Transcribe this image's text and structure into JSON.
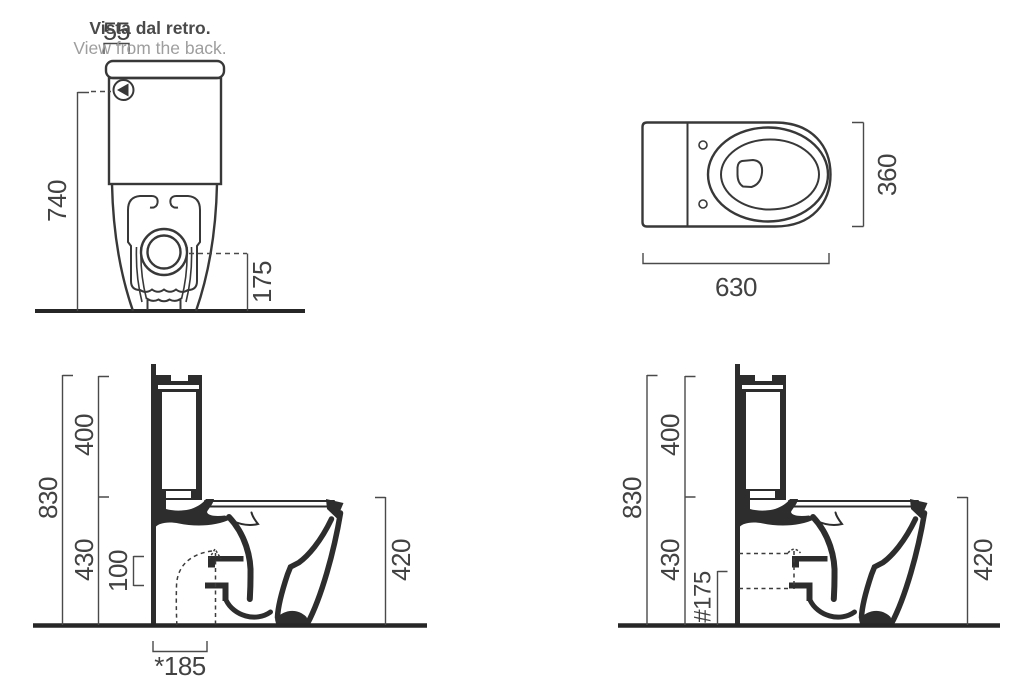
{
  "colors": {
    "line": "#383838",
    "section_fill": "#2d2d2d",
    "dim_line": "#4a4a4a",
    "dim_text": "#424242",
    "title_dark": "#4a4a4a",
    "title_light": "#9e9e9e",
    "ground": "#262626",
    "background": "#ffffff"
  },
  "back_view": {
    "title_it": "Vista dal retro.",
    "title_en": "View from the back.",
    "inlet_offset": "55",
    "inlet_height": "740",
    "outlet_height": "175"
  },
  "top_view": {
    "length": "630",
    "width": "360"
  },
  "side_view_floor": {
    "total_height": "830",
    "cistern_height": "400",
    "underseat_height": "430",
    "outlet_offset": "100",
    "bowl_height": "420",
    "outlet_distance": "*185"
  },
  "side_view_wall": {
    "total_height": "830",
    "cistern_height": "400",
    "underseat_height": "430",
    "outlet_height": "#175",
    "bowl_height": "420"
  }
}
